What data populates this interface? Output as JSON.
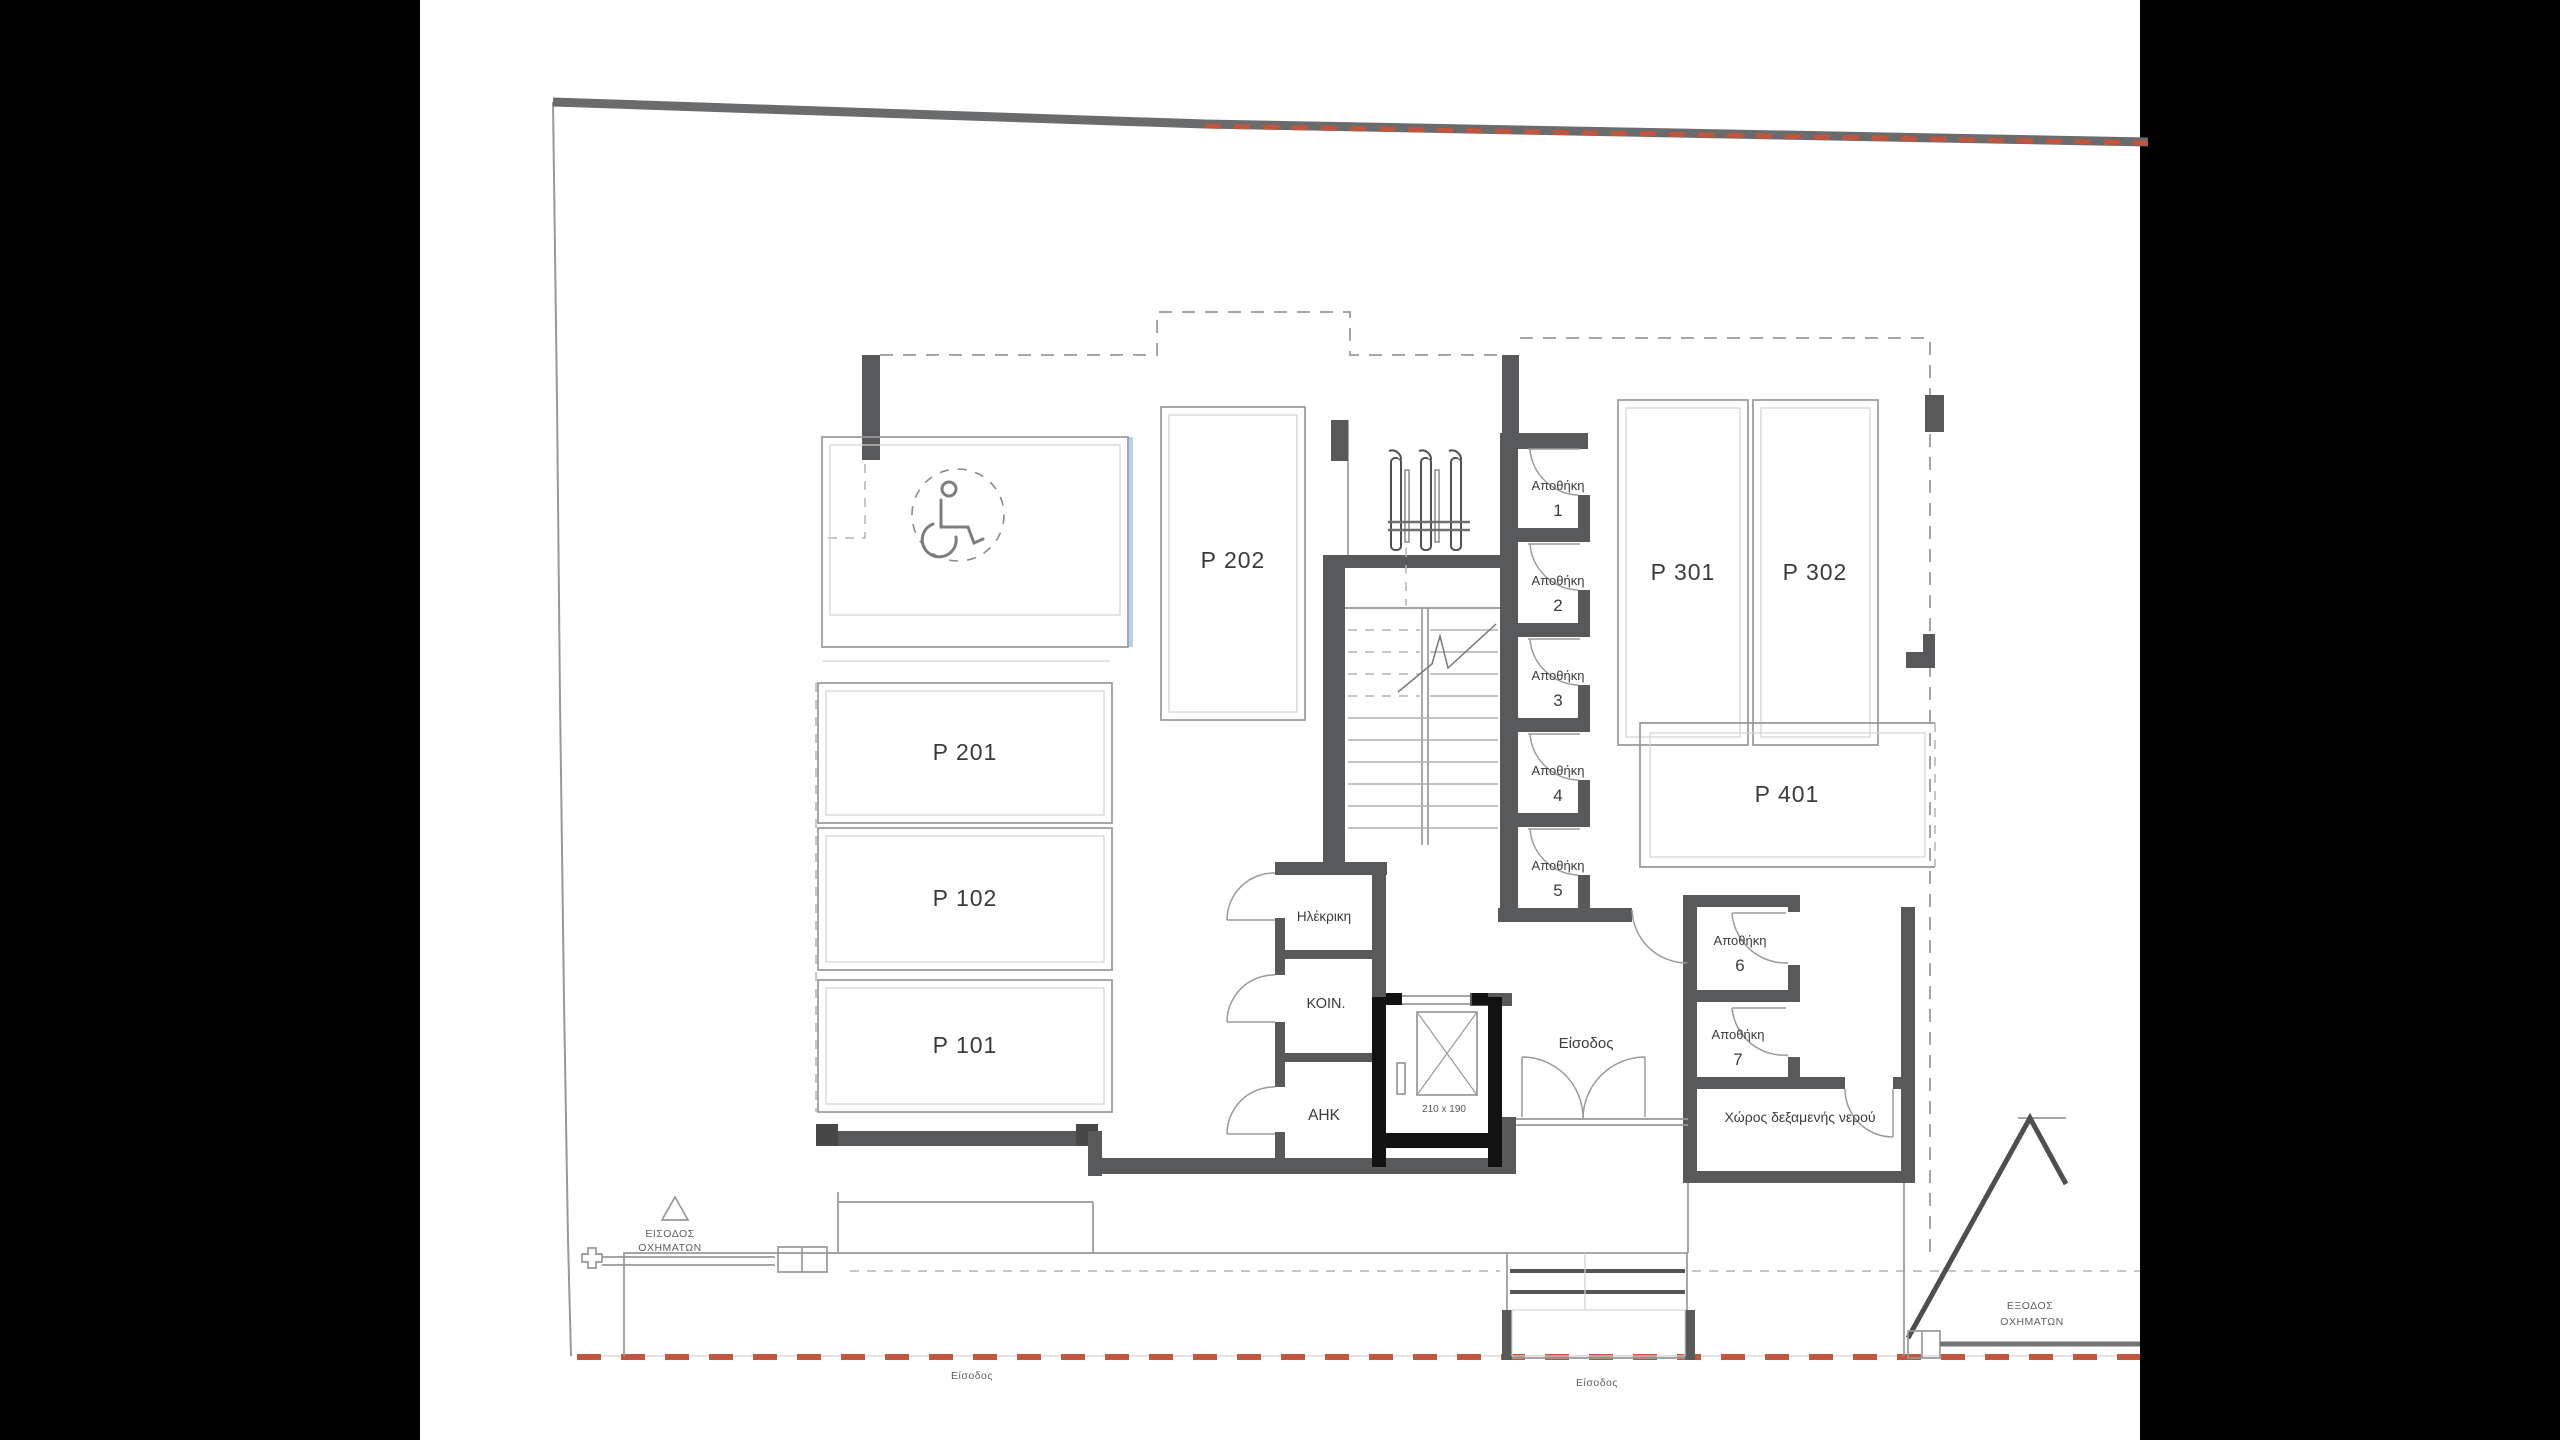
{
  "document": {
    "type": "architectural-floor-plan-parking-level",
    "language": "el"
  },
  "colors": {
    "background": "#000000",
    "paper": "#ffffff",
    "wall_gray": "#58595a",
    "wall_black": "#121212",
    "line_gray": "#98989a",
    "boundary_red": "#c05540",
    "accessible_blue": "#b5d2e6",
    "text": "#3b3b3c"
  },
  "parking": {
    "p101": "P 101",
    "p102": "P 102",
    "p201": "P 201",
    "p202": "P 202",
    "p301": "P 301",
    "p302": "P 302",
    "p401": "P 401"
  },
  "storage": {
    "word": "Αποθήκη",
    "numbers": [
      "1",
      "2",
      "3",
      "4",
      "5",
      "6",
      "7"
    ]
  },
  "rooms": {
    "electrical": "Ηλέκρικη",
    "communal": "ΚΟΙΝ.",
    "power": "ΑΗΚ",
    "water_tank": "Χώρος δεξαμενής νερού"
  },
  "labels": {
    "entrance": "Είσοδος",
    "entrance_pedestrian_west": "Είσοδος",
    "entrance_pedestrian_south": "Είσοδος",
    "vehicle_entrance_line1": "ΕΙΣΟΔΟΣ",
    "vehicle_entrance_line2": "ΟΧΗΜΑΤΩΝ",
    "vehicle_exit_line1": "ΕΞΟΔΟΣ",
    "vehicle_exit_line2": "ΟΧΗΜΑΤΩΝ",
    "elevator_size": "210 x 190"
  }
}
